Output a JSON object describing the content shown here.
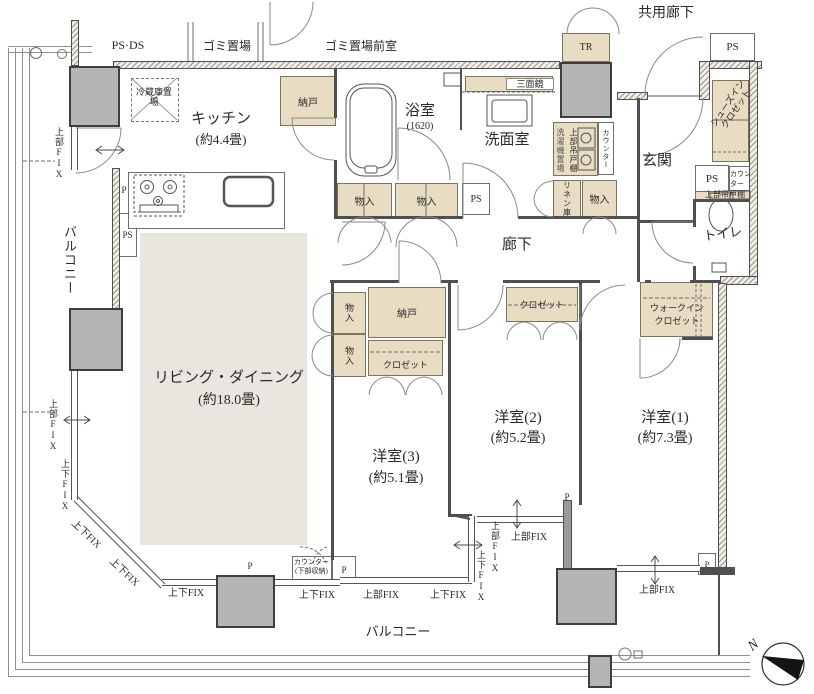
{
  "exterior": {
    "common_corridor": "共用廊下",
    "ps_ds": "PS·DS",
    "garbage_area": "ゴミ置場",
    "garbage_anteroom": "ゴミ置場前室",
    "trunk_room": "TR",
    "balcony_left": "バルコニー",
    "balcony_bottom": "バルコニー",
    "north_mark": "N"
  },
  "rooms": {
    "kitchen": {
      "name": "キッチン",
      "size": "(約4.4畳)"
    },
    "bath": {
      "name": "浴室",
      "size": "(1620)"
    },
    "washroom": {
      "name": "洗面室"
    },
    "entrance": {
      "name": "玄関"
    },
    "toilet": {
      "name": "トイレ"
    },
    "hallway": {
      "name": "廊下"
    },
    "living_dining": {
      "name": "リビング・ダイニング",
      "size": "(約18.0畳)"
    },
    "bedroom1": {
      "name": "洋室(1)",
      "size": "(約7.3畳)"
    },
    "bedroom2": {
      "name": "洋室(2)",
      "size": "(約5.2畳)"
    },
    "bedroom3": {
      "name": "洋室(3)",
      "size": "(約5.1畳)"
    }
  },
  "storage": {
    "refrigerator_space": "冷蔵庫置場",
    "storeroom": "納戸",
    "closet": "クロゼット",
    "walk_in_closet_line1": "ウォークイン",
    "walk_in_closet_line2": "クロゼット",
    "shoes_in_closet": "シューズインクロゼット",
    "cabinet": "物入",
    "linen_cabinet": "リネン庫",
    "three_way_mirror": "三面鏡",
    "washer_space": "洗濯機置場",
    "upper_cabinet": "上部吊戸棚",
    "counter": "カウンター",
    "counter_lower_line1": "カウンター",
    "counter_lower_line2": "(下部収納)"
  },
  "marks": {
    "p": "P",
    "ps": "PS",
    "upper_fix": "上部FIX",
    "upper_lower_fix": "上下FIX"
  },
  "colors": {
    "closet_fill": "#e8dcc2",
    "living_fill": "#e9e6e0",
    "pillar_fill": "#b5b5b5"
  }
}
